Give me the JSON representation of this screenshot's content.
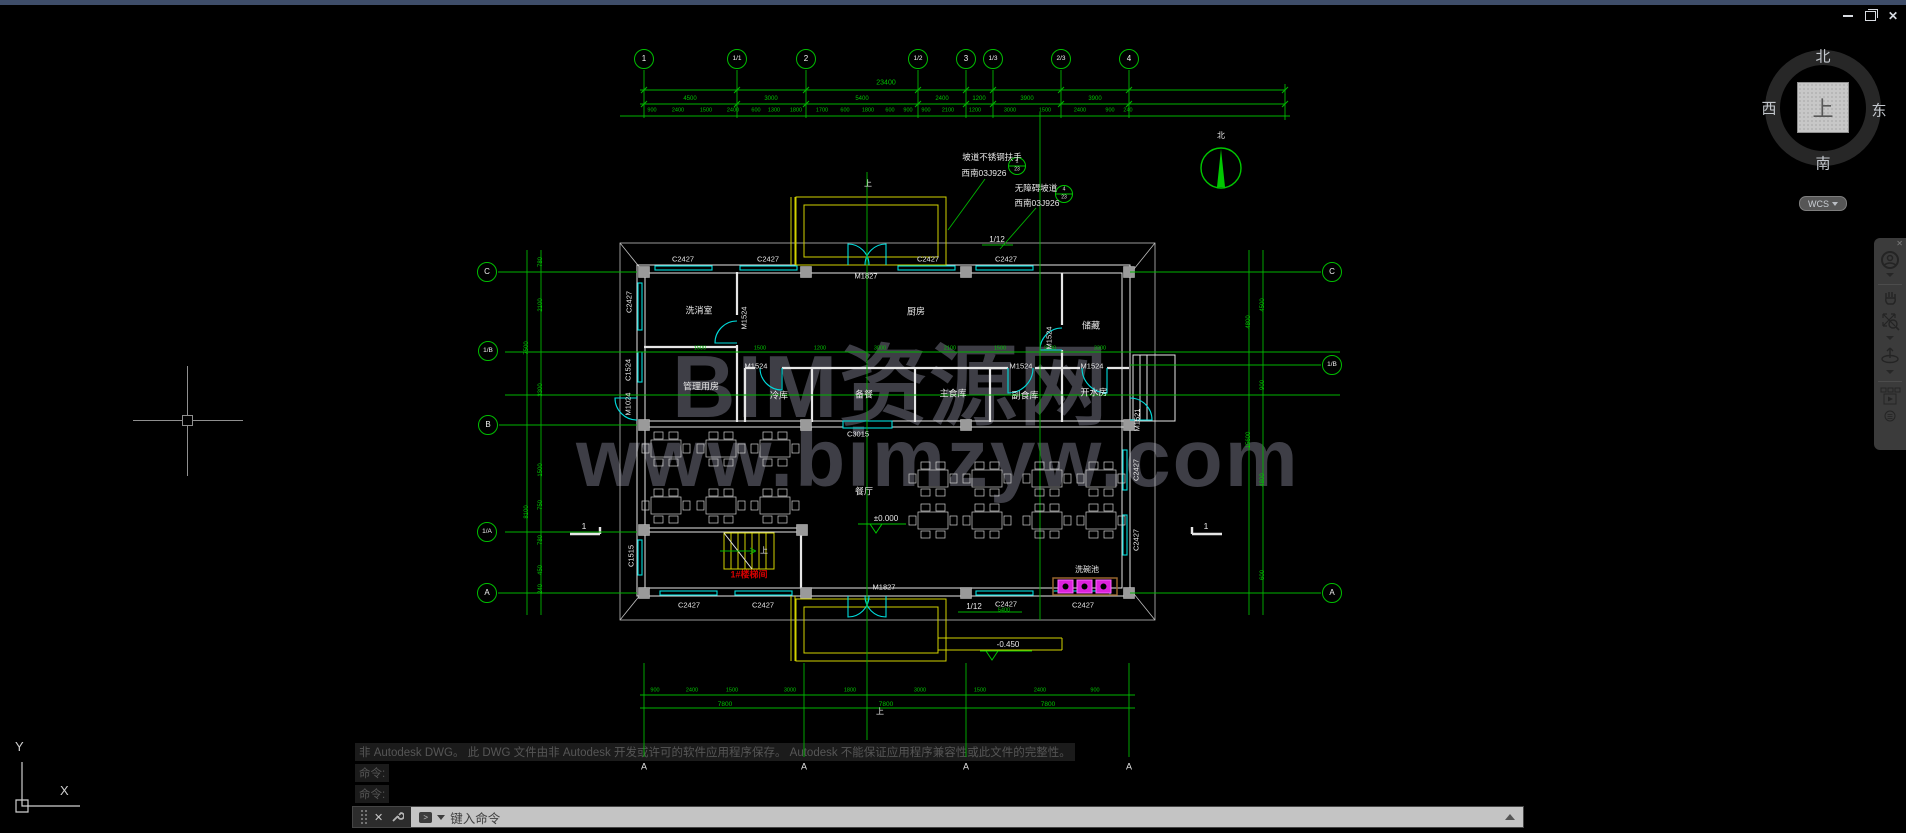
{
  "window": {
    "close_label": "✕"
  },
  "viewcube": {
    "north": "北",
    "south": "南",
    "west": "西",
    "east": "东",
    "up": "上",
    "wcs_label": "WCS"
  },
  "navbar": {
    "icons": [
      "full-navigation-wheel",
      "pan",
      "zoom",
      "orbit",
      "show-motion"
    ]
  },
  "watermark": {
    "line1": "BIM资源网",
    "line2": "www.bimzyw.com"
  },
  "ucs": {
    "x_label": "X",
    "y_label": "Y"
  },
  "command": {
    "history": [
      "非 Autodesk DWG。  此 DWG 文件由非 Autodesk 开发或许可的软件应用程序保存。  Autodesk 不能保证应用程序兼容性或此文件的完整性。",
      "命令:",
      "命令:"
    ],
    "close_glyph": "✕",
    "prompt_glyph": ">",
    "prompt_placeholder": "键入命令"
  },
  "plan": {
    "bubbles": [
      {
        "t": "1",
        "x": 644,
        "y": 59
      },
      {
        "t": "1/1",
        "x": 737,
        "y": 59,
        "fs": 6.5
      },
      {
        "t": "2",
        "x": 806,
        "y": 59
      },
      {
        "t": "1/2",
        "x": 918,
        "y": 59,
        "fs": 6.5
      },
      {
        "t": "3",
        "x": 966,
        "y": 59
      },
      {
        "t": "1/3",
        "x": 993,
        "y": 59,
        "fs": 6.5
      },
      {
        "t": "2/3",
        "x": 1061,
        "y": 59,
        "fs": 6.5
      },
      {
        "t": "4",
        "x": 1129,
        "y": 59
      },
      {
        "t": "C",
        "x": 487,
        "y": 272
      },
      {
        "t": "1/B",
        "x": 488,
        "y": 351,
        "fs": 6.5
      },
      {
        "t": "B",
        "x": 488,
        "y": 425
      },
      {
        "t": "1/A",
        "x": 487,
        "y": 532,
        "fs": 6.5
      },
      {
        "t": "A",
        "x": 487,
        "y": 593
      },
      {
        "t": "C",
        "x": 1332,
        "y": 272
      },
      {
        "t": "1/B",
        "x": 1332,
        "y": 365,
        "fs": 6.5
      },
      {
        "t": "A",
        "x": 1332,
        "y": 593
      }
    ],
    "markers": [
      {
        "t": "A",
        "x": 644,
        "y": 767
      },
      {
        "t": "A",
        "x": 804,
        "y": 767
      },
      {
        "t": "A",
        "x": 966,
        "y": 767
      },
      {
        "t": "A",
        "x": 1129,
        "y": 767
      }
    ],
    "dims": [
      {
        "t": "23400",
        "x": 886,
        "y": 83,
        "fs": 7
      },
      {
        "t": "4500",
        "x": 690,
        "y": 99
      },
      {
        "t": "3000",
        "x": 771,
        "y": 99
      },
      {
        "t": "5400",
        "x": 862,
        "y": 99
      },
      {
        "t": "2400",
        "x": 942,
        "y": 99
      },
      {
        "t": "1200",
        "x": 979,
        "y": 99
      },
      {
        "t": "3900",
        "x": 1027,
        "y": 99
      },
      {
        "t": "3900",
        "x": 1095,
        "y": 99
      },
      {
        "t": "900",
        "x": 652,
        "y": 111,
        "fs": 5.5
      },
      {
        "t": "2400",
        "x": 678,
        "y": 111,
        "fs": 5.5
      },
      {
        "t": "1500",
        "x": 706,
        "y": 111,
        "fs": 5.5
      },
      {
        "t": "2400",
        "x": 733,
        "y": 111,
        "fs": 5.5
      },
      {
        "t": "600",
        "x": 756,
        "y": 111,
        "fs": 5.5
      },
      {
        "t": "1300",
        "x": 774,
        "y": 111,
        "fs": 5.5
      },
      {
        "t": "1800",
        "x": 796,
        "y": 111,
        "fs": 5.5
      },
      {
        "t": "1700",
        "x": 822,
        "y": 111,
        "fs": 5.5
      },
      {
        "t": "600",
        "x": 845,
        "y": 111,
        "fs": 5.5
      },
      {
        "t": "1800",
        "x": 868,
        "y": 111,
        "fs": 5.5
      },
      {
        "t": "600",
        "x": 890,
        "y": 111,
        "fs": 5.5
      },
      {
        "t": "900",
        "x": 908,
        "y": 111,
        "fs": 5.5
      },
      {
        "t": "900",
        "x": 926,
        "y": 111,
        "fs": 5.5
      },
      {
        "t": "2100",
        "x": 948,
        "y": 111,
        "fs": 5.5
      },
      {
        "t": "1200",
        "x": 975,
        "y": 111,
        "fs": 5.5
      },
      {
        "t": "3000",
        "x": 1010,
        "y": 111,
        "fs": 5.5
      },
      {
        "t": "1500",
        "x": 1045,
        "y": 111,
        "fs": 5.5
      },
      {
        "t": "2400",
        "x": 1080,
        "y": 111,
        "fs": 5.5
      },
      {
        "t": "900",
        "x": 1110,
        "y": 111,
        "fs": 5.5
      },
      {
        "t": "240",
        "x": 1128,
        "y": 111,
        "fs": 5.5
      },
      {
        "t": "1500",
        "x": 700,
        "y": 349,
        "fs": 5.5
      },
      {
        "t": "1500",
        "x": 760,
        "y": 349,
        "fs": 5.5
      },
      {
        "t": "1200",
        "x": 820,
        "y": 349,
        "fs": 5.5
      },
      {
        "t": "3000",
        "x": 880,
        "y": 349,
        "fs": 5.5
      },
      {
        "t": "2100",
        "x": 950,
        "y": 349,
        "fs": 5.5
      },
      {
        "t": "1500",
        "x": 1000,
        "y": 349,
        "fs": 5.5
      },
      {
        "t": "2100",
        "x": 1050,
        "y": 349,
        "fs": 5.5
      },
      {
        "t": "3300",
        "x": 1100,
        "y": 349,
        "fs": 5.5
      },
      {
        "t": "780",
        "x": 541,
        "y": 262,
        "r": -90
      },
      {
        "t": "2100",
        "x": 541,
        "y": 305,
        "r": -90
      },
      {
        "t": "3300",
        "x": 541,
        "y": 390,
        "r": -90
      },
      {
        "t": "1500",
        "x": 541,
        "y": 470,
        "r": -90
      },
      {
        "t": "750",
        "x": 541,
        "y": 505,
        "r": -90
      },
      {
        "t": "780",
        "x": 541,
        "y": 540,
        "r": -90
      },
      {
        "t": "450",
        "x": 541,
        "y": 570,
        "r": -90
      },
      {
        "t": "240",
        "x": 541,
        "y": 589,
        "r": -90
      },
      {
        "t": "7500",
        "x": 527,
        "y": 348,
        "r": -90
      },
      {
        "t": "8100",
        "x": 527,
        "y": 512,
        "r": -90
      },
      {
        "t": "4500",
        "x": 1263,
        "y": 305,
        "r": -90
      },
      {
        "t": "4800",
        "x": 1249,
        "y": 322,
        "r": -90
      },
      {
        "t": "900",
        "x": 1263,
        "y": 385,
        "r": -90
      },
      {
        "t": "4800",
        "x": 1263,
        "y": 480,
        "r": -90
      },
      {
        "t": "600",
        "x": 1263,
        "y": 575,
        "r": -90
      },
      {
        "t": "15600",
        "x": 1249,
        "y": 440,
        "r": -90
      },
      {
        "t": "900",
        "x": 655,
        "y": 691,
        "fs": 5.5
      },
      {
        "t": "2400",
        "x": 692,
        "y": 691,
        "fs": 5.5
      },
      {
        "t": "1500",
        "x": 732,
        "y": 691,
        "fs": 5.5
      },
      {
        "t": "3000",
        "x": 790,
        "y": 691,
        "fs": 5.5
      },
      {
        "t": "1800",
        "x": 850,
        "y": 691,
        "fs": 5.5
      },
      {
        "t": "3000",
        "x": 920,
        "y": 691,
        "fs": 5.5
      },
      {
        "t": "1500",
        "x": 980,
        "y": 691,
        "fs": 5.5
      },
      {
        "t": "2400",
        "x": 1040,
        "y": 691,
        "fs": 5.5
      },
      {
        "t": "900",
        "x": 1095,
        "y": 691,
        "fs": 5.5
      },
      {
        "t": "7800",
        "x": 725,
        "y": 705,
        "fs": 6.5
      },
      {
        "t": "7800",
        "x": 886,
        "y": 705,
        "fs": 6.5
      },
      {
        "t": "7800",
        "x": 1048,
        "y": 705,
        "fs": 6.5
      },
      {
        "t": "5400",
        "x": 1004,
        "y": 611,
        "fs": 5.5
      }
    ],
    "rooms": [
      {
        "t": "洗消室",
        "x": 699,
        "y": 311
      },
      {
        "t": "厨房",
        "x": 916,
        "y": 312
      },
      {
        "t": "储藏",
        "x": 1091,
        "y": 326
      },
      {
        "t": "管理用房",
        "x": 701,
        "y": 387
      },
      {
        "t": "冷库",
        "x": 779,
        "y": 396
      },
      {
        "t": "备餐",
        "x": 864,
        "y": 395
      },
      {
        "t": "主食库",
        "x": 953,
        "y": 394
      },
      {
        "t": "副食库",
        "x": 1025,
        "y": 396
      },
      {
        "t": "开水房",
        "x": 1094,
        "y": 393
      },
      {
        "t": "餐厅",
        "x": 864,
        "y": 492
      },
      {
        "t": "洗碗池",
        "x": 1087,
        "y": 570,
        "fs": 8
      }
    ],
    "openings": [
      {
        "t": "C2427",
        "x": 683,
        "y": 259
      },
      {
        "t": "C2427",
        "x": 768,
        "y": 259
      },
      {
        "t": "C2427",
        "x": 928,
        "y": 259
      },
      {
        "t": "C2427",
        "x": 1006,
        "y": 259
      },
      {
        "t": "M1827",
        "x": 866,
        "y": 276
      },
      {
        "t": "C3015",
        "x": 858,
        "y": 434
      },
      {
        "t": "M1827",
        "x": 884,
        "y": 587
      },
      {
        "t": "C2427",
        "x": 689,
        "y": 605
      },
      {
        "t": "C2427",
        "x": 763,
        "y": 605
      },
      {
        "t": "C2427",
        "x": 1006,
        "y": 604
      },
      {
        "t": "C2427",
        "x": 1083,
        "y": 605
      },
      {
        "t": "M1524",
        "x": 756,
        "y": 366
      },
      {
        "t": "M1524",
        "x": 1021,
        "y": 366
      },
      {
        "t": "M1524",
        "x": 1092,
        "y": 366
      },
      {
        "t": "M1524",
        "x": 744,
        "y": 318,
        "r": -90
      },
      {
        "t": "M1524",
        "x": 1049,
        "y": 338,
        "r": -90
      },
      {
        "t": "C2427",
        "x": 629,
        "y": 302,
        "r": -90
      },
      {
        "t": "C1524",
        "x": 628,
        "y": 370,
        "r": -90
      },
      {
        "t": "M1024",
        "x": 628,
        "y": 404,
        "r": -90
      },
      {
        "t": "C1515",
        "x": 631,
        "y": 556,
        "r": -90
      },
      {
        "t": "M1521",
        "x": 1137,
        "y": 420,
        "r": -90
      },
      {
        "t": "C2427",
        "x": 1136,
        "y": 470,
        "r": -90
      },
      {
        "t": "C2427",
        "x": 1136,
        "y": 540,
        "r": -90
      }
    ],
    "annotations": [
      {
        "t": "坡道不锈钢扶手",
        "x": 992,
        "y": 157,
        "fs": 8.5,
        "n": "ramp-handrail-note"
      },
      {
        "t": "西南03J926",
        "x": 984,
        "y": 173,
        "fs": 8.5,
        "n": "detail-standard-ref"
      },
      {
        "t": "无障碍坡道",
        "x": 1036,
        "y": 188,
        "fs": 8.5,
        "n": "accessible-ramp-note"
      },
      {
        "t": "西南03J926",
        "x": 1037,
        "y": 203,
        "fs": 8.5,
        "n": "detail-standard-ref"
      },
      {
        "t": "1",
        "x": 1017,
        "y": 162,
        "fs": 5,
        "n": "detail-bubble-number"
      },
      {
        "t": "23",
        "x": 1017,
        "y": 170,
        "fs": 5,
        "n": "detail-bubble-page"
      },
      {
        "t": "4",
        "x": 1064,
        "y": 190,
        "fs": 5,
        "n": "detail-bubble-number"
      },
      {
        "t": "23",
        "x": 1064,
        "y": 198,
        "fs": 5,
        "n": "detail-bubble-page"
      },
      {
        "t": "1/12",
        "x": 997,
        "y": 240,
        "n": "ramp-slope-label"
      },
      {
        "t": "1/12",
        "x": 974,
        "y": 607,
        "n": "ramp-slope-label"
      },
      {
        "t": "±0.000",
        "x": 886,
        "y": 519,
        "n": "elevation-marker"
      },
      {
        "t": "-0.450",
        "x": 1008,
        "y": 645,
        "n": "elevation-marker"
      },
      {
        "t": "上",
        "x": 868,
        "y": 184,
        "n": "up-arrow-label"
      },
      {
        "t": "上",
        "x": 880,
        "y": 712,
        "n": "up-arrow-label"
      },
      {
        "t": "上",
        "x": 764,
        "y": 551,
        "n": "up-arrow-label"
      },
      {
        "t": "1#楼梯间",
        "x": 749,
        "y": 575,
        "c": "rd",
        "fs": 9,
        "n": "stair-label"
      },
      {
        "t": "1",
        "x": 584,
        "y": 526,
        "fs": 8.5,
        "n": "section-mark-number"
      },
      {
        "t": "1",
        "x": 1206,
        "y": 526,
        "fs": 8.5,
        "n": "section-mark-number"
      },
      {
        "t": "北",
        "x": 1221,
        "y": 136,
        "n": "north-arrow-label"
      }
    ],
    "tables": [
      [
        651,
        440
      ],
      [
        706,
        440
      ],
      [
        760,
        440
      ],
      [
        651,
        497
      ],
      [
        706,
        497
      ],
      [
        760,
        497
      ],
      [
        918,
        470
      ],
      [
        972,
        470
      ],
      [
        1032,
        470
      ],
      [
        1086,
        470
      ],
      [
        918,
        512
      ],
      [
        972,
        512
      ],
      [
        1032,
        512
      ],
      [
        1086,
        512
      ]
    ],
    "sinks": [
      [
        1058,
        580
      ],
      [
        1077,
        580
      ],
      [
        1096,
        580
      ]
    ]
  }
}
